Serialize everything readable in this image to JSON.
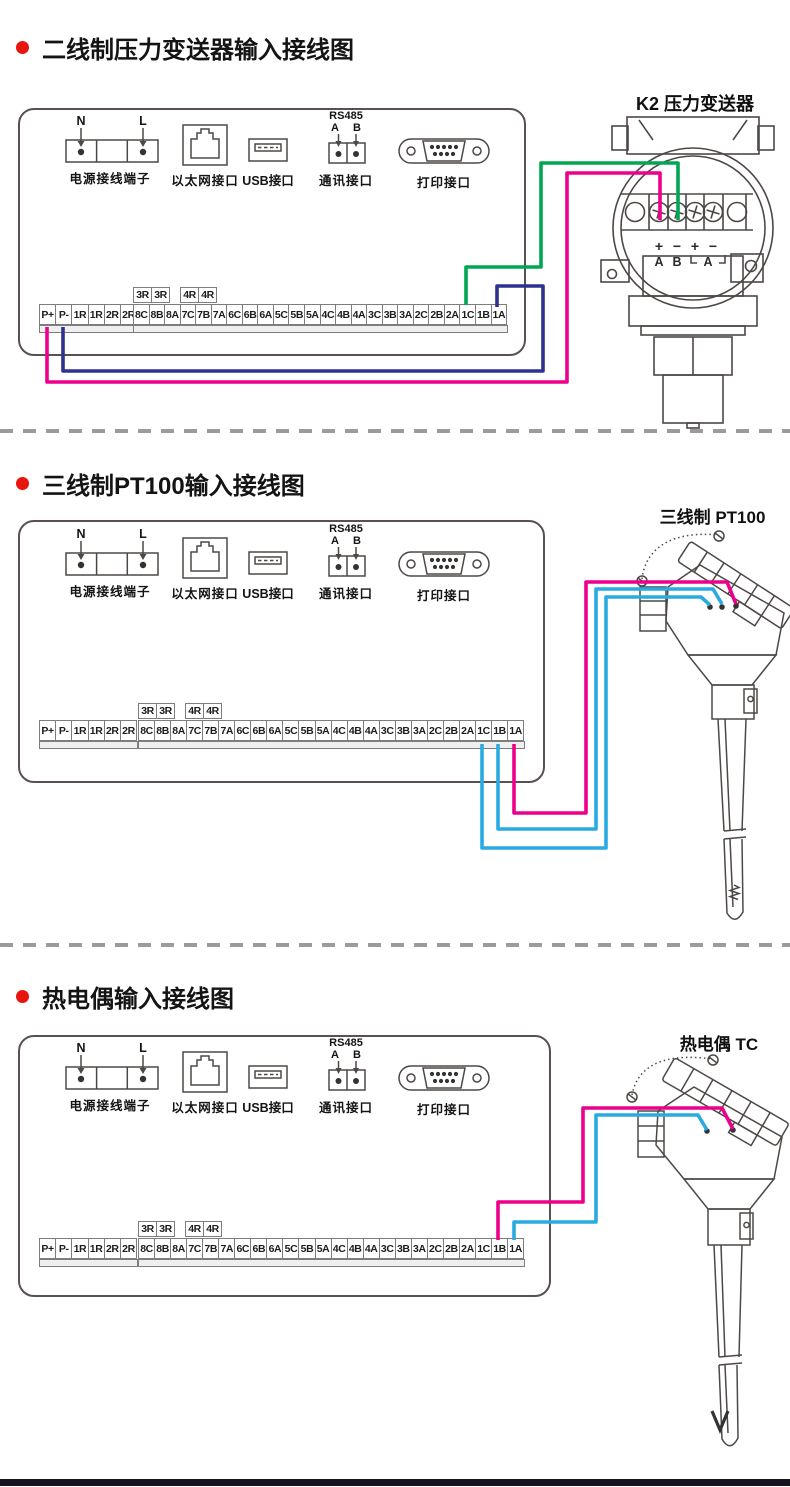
{
  "sections": [
    {
      "title": "二线制压力变送器输入接线图",
      "sensor_label": "K2 压力变送器"
    },
    {
      "title": "三线制PT100输入接线图",
      "sensor_label": "三线制 PT100"
    },
    {
      "title": "热电偶输入接线图",
      "sensor_label": "热电偶 TC"
    }
  ],
  "ports": {
    "power": {
      "label": "电源接线端子",
      "terminal_n": "N",
      "terminal_l": "L"
    },
    "ethernet": {
      "label": "以太网接口"
    },
    "usb": {
      "label": "USB接口"
    },
    "comm": {
      "label": "通讯接口",
      "protocol": "RS485",
      "line_a": "A",
      "line_b": "B"
    },
    "printer": {
      "label": "打印接口"
    }
  },
  "terminal_strip": {
    "relay_cells": [
      "3R",
      "3R",
      "4R",
      "4R"
    ],
    "left_cells": [
      "P+",
      "P-",
      "1R",
      "1R",
      "2R",
      "2R"
    ],
    "main_cells": [
      "8C",
      "8B",
      "8A",
      "7C",
      "7B",
      "7A",
      "6C",
      "6B",
      "6A",
      "5C",
      "5B",
      "5A",
      "4C",
      "4B",
      "4A",
      "3C",
      "3B",
      "3A",
      "2C",
      "2B",
      "2A",
      "1C",
      "1B",
      "1A"
    ]
  },
  "transmitter": {
    "polarity_labels": [
      "+",
      "−",
      "+",
      "−"
    ],
    "channel_labels": [
      "A",
      "B",
      "A"
    ]
  },
  "colors": {
    "wire_green": "#00A651",
    "wire_magenta": "#EC008C",
    "wire_blue": "#2E3192",
    "wire_cyan": "#29ABE2",
    "bullet_red": "#E8150C",
    "line_gray": "#4d4846"
  }
}
